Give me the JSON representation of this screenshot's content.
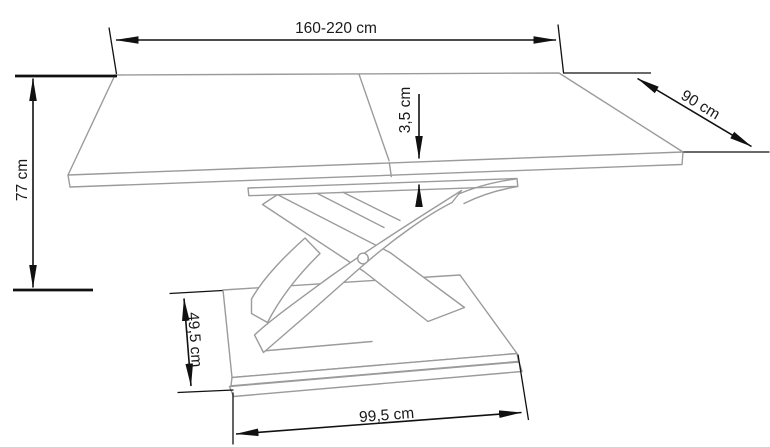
{
  "diagram": {
    "subject": "extendable-table-dimension-drawing",
    "dimensions": {
      "length": "160-220 cm",
      "depth": "90 cm",
      "top_thickness": "3,5 cm",
      "height": "77 cm",
      "base_depth": "49,5 cm",
      "base_width": "99,5 cm"
    },
    "colors": {
      "artwork_line": "#9b9b9b",
      "dimension_line": "#111111",
      "label_text": "#1a1a1a",
      "background": "#ffffff"
    }
  }
}
